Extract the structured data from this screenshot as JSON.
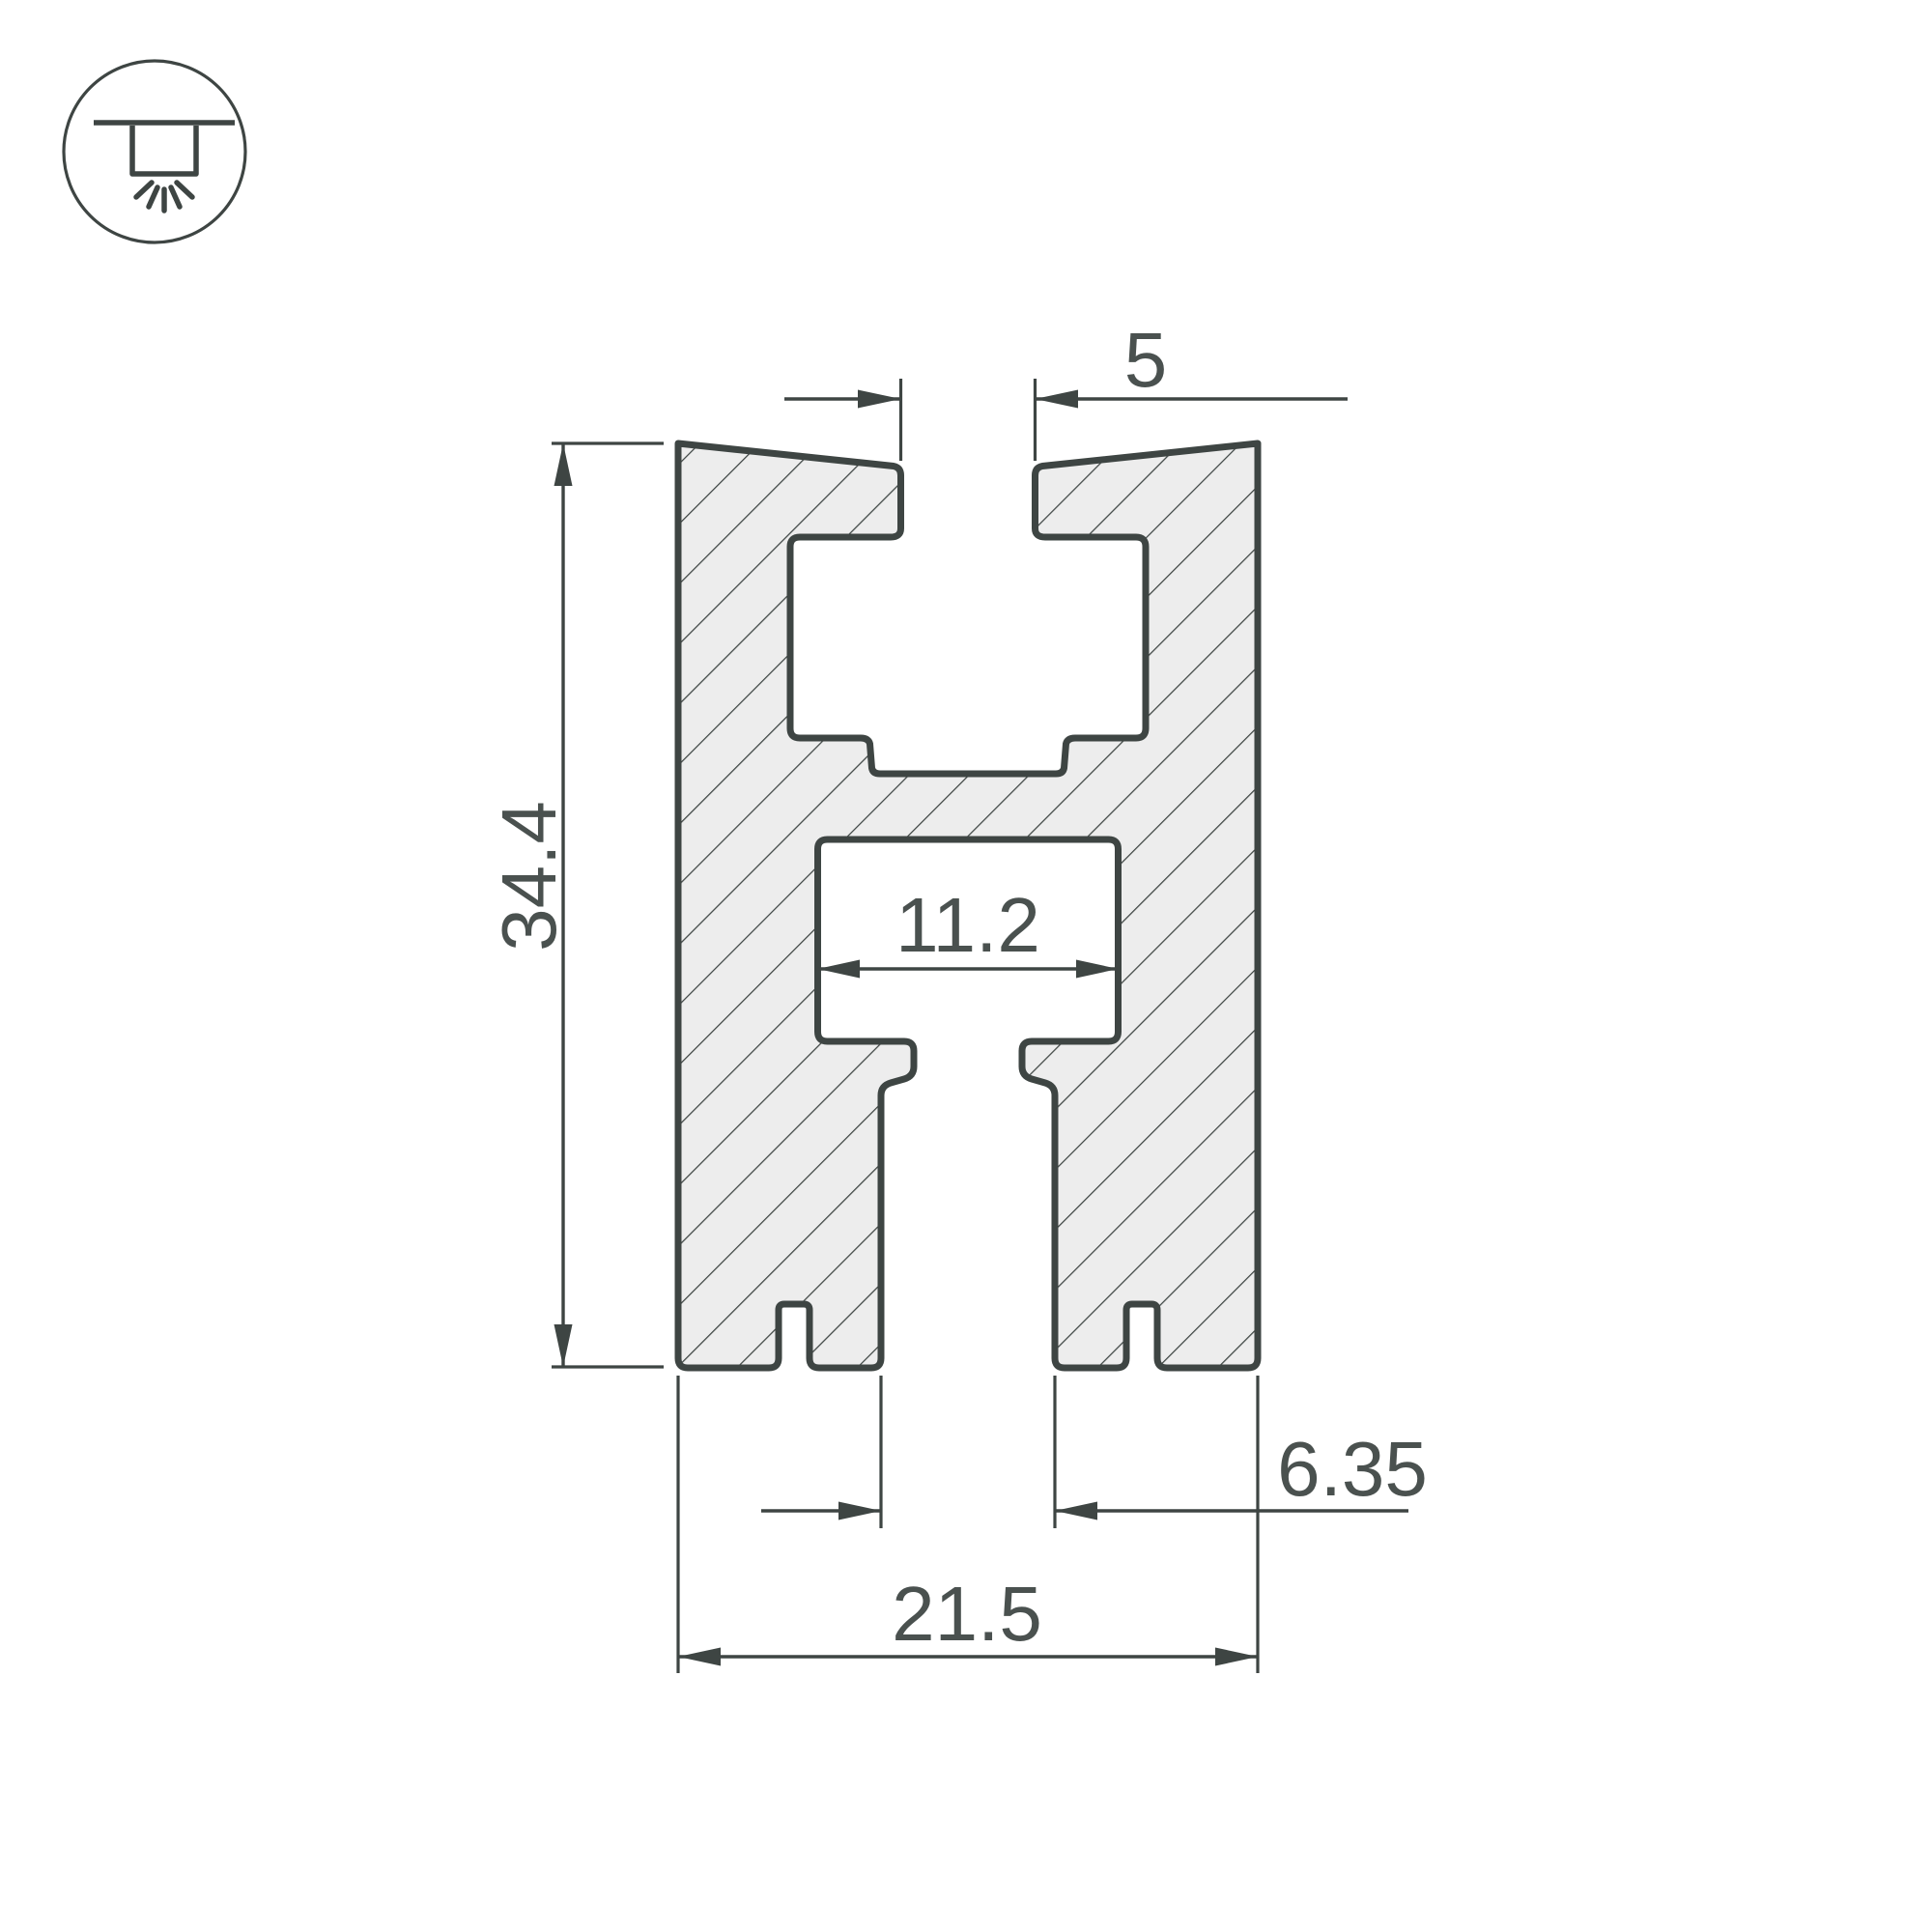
{
  "title": "Aluminium LED profile cross-section drawing",
  "icon": {
    "name": "recessed-ceiling-light",
    "description": "circle badge with recessed downlight fixture and light rays"
  },
  "dimensions": {
    "top_slot_width": {
      "label": "5"
    },
    "overall_height": {
      "label": "34.4"
    },
    "inner_cavity_width": {
      "label": "11.2"
    },
    "bottom_slot_width": {
      "label": "6.35"
    },
    "overall_width": {
      "label": "21.5"
    }
  },
  "colors": {
    "line": "#3E4543",
    "text": "#4A514F",
    "hatch_fill": "#EDEDED",
    "background": "#FFFFFF"
  }
}
